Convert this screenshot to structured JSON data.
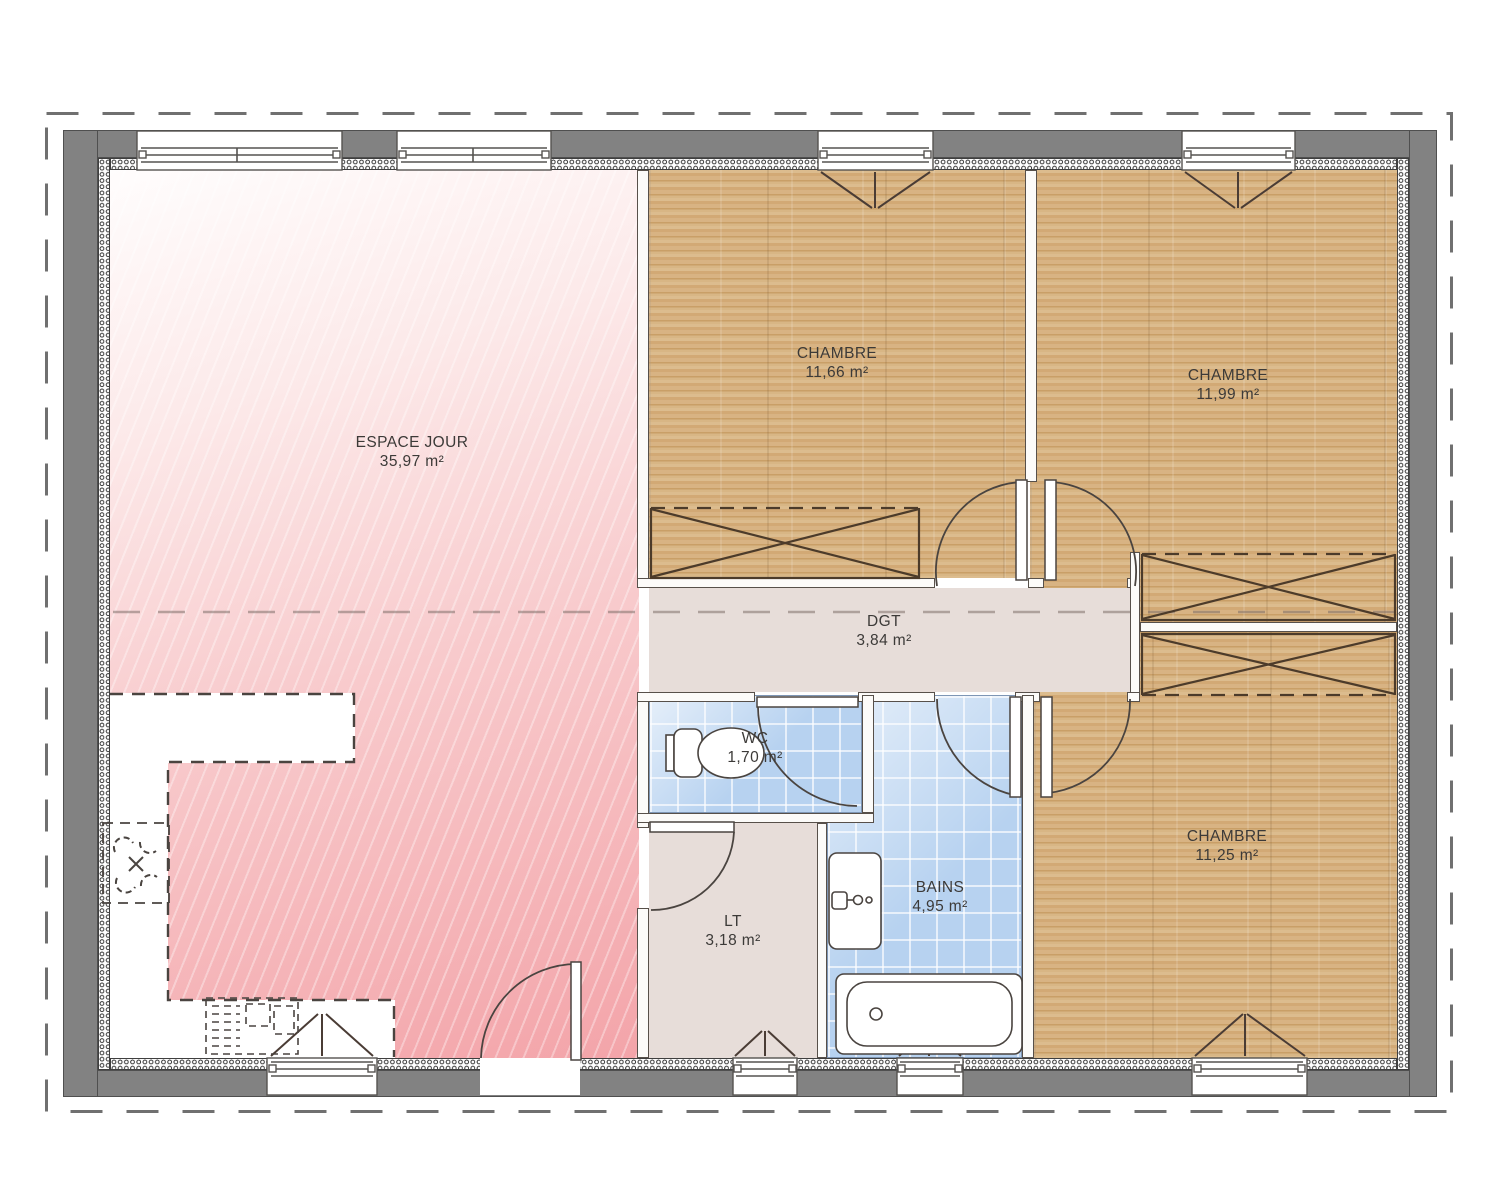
{
  "plan_type": "house floor plan",
  "rooms": [
    {
      "id": "espace-jour",
      "name": "ESPACE JOUR",
      "area": "35,97 m²"
    },
    {
      "id": "chambre-1",
      "name": "CHAMBRE",
      "area": "11,66 m²"
    },
    {
      "id": "chambre-2",
      "name": "CHAMBRE",
      "area": "11,99 m²"
    },
    {
      "id": "dgt",
      "name": "DGT",
      "area": "3,84 m²"
    },
    {
      "id": "wc",
      "name": "WC",
      "area": "1,70 m²"
    },
    {
      "id": "bains",
      "name": "BAINS",
      "area": "4,95 m²"
    },
    {
      "id": "lt",
      "name": "LT",
      "area": "3,18 m²"
    },
    {
      "id": "chambre-3",
      "name": "CHAMBRE",
      "area": "11,25 m²"
    }
  ],
  "colors": {
    "wall": "#828282",
    "living": "#f3a4a9",
    "wood": "#d4ad7a",
    "tile": "#b7d2f0",
    "hall": "#e7ddd9",
    "line": "#4a4440"
  }
}
